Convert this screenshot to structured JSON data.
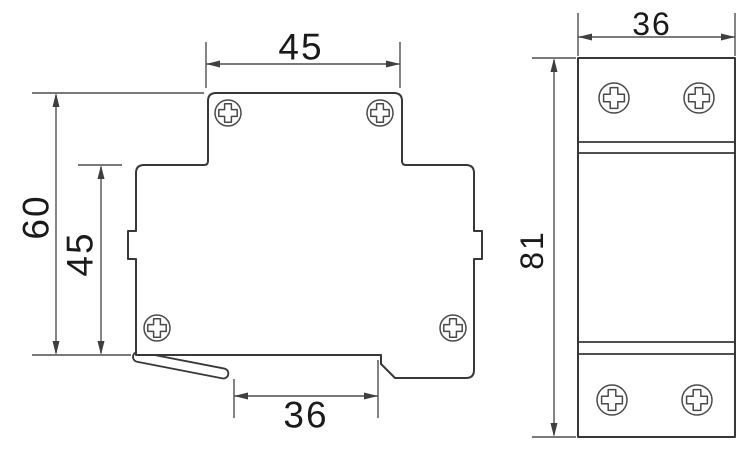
{
  "drawing": {
    "colors": {
      "background": "#ffffff",
      "outline": "#383838",
      "dimline": "#4f4f4f",
      "arrow": "#3f3f3f",
      "label": "#1a1a1a"
    },
    "front_view": {
      "dimensions": {
        "top_width": "45",
        "overall_height": "60",
        "lower_body_height": "45",
        "bottom_recess_width": "36"
      },
      "screw_count": 4
    },
    "side_view": {
      "dimensions": {
        "width": "36",
        "height": "81"
      },
      "screw_count": 4
    }
  }
}
